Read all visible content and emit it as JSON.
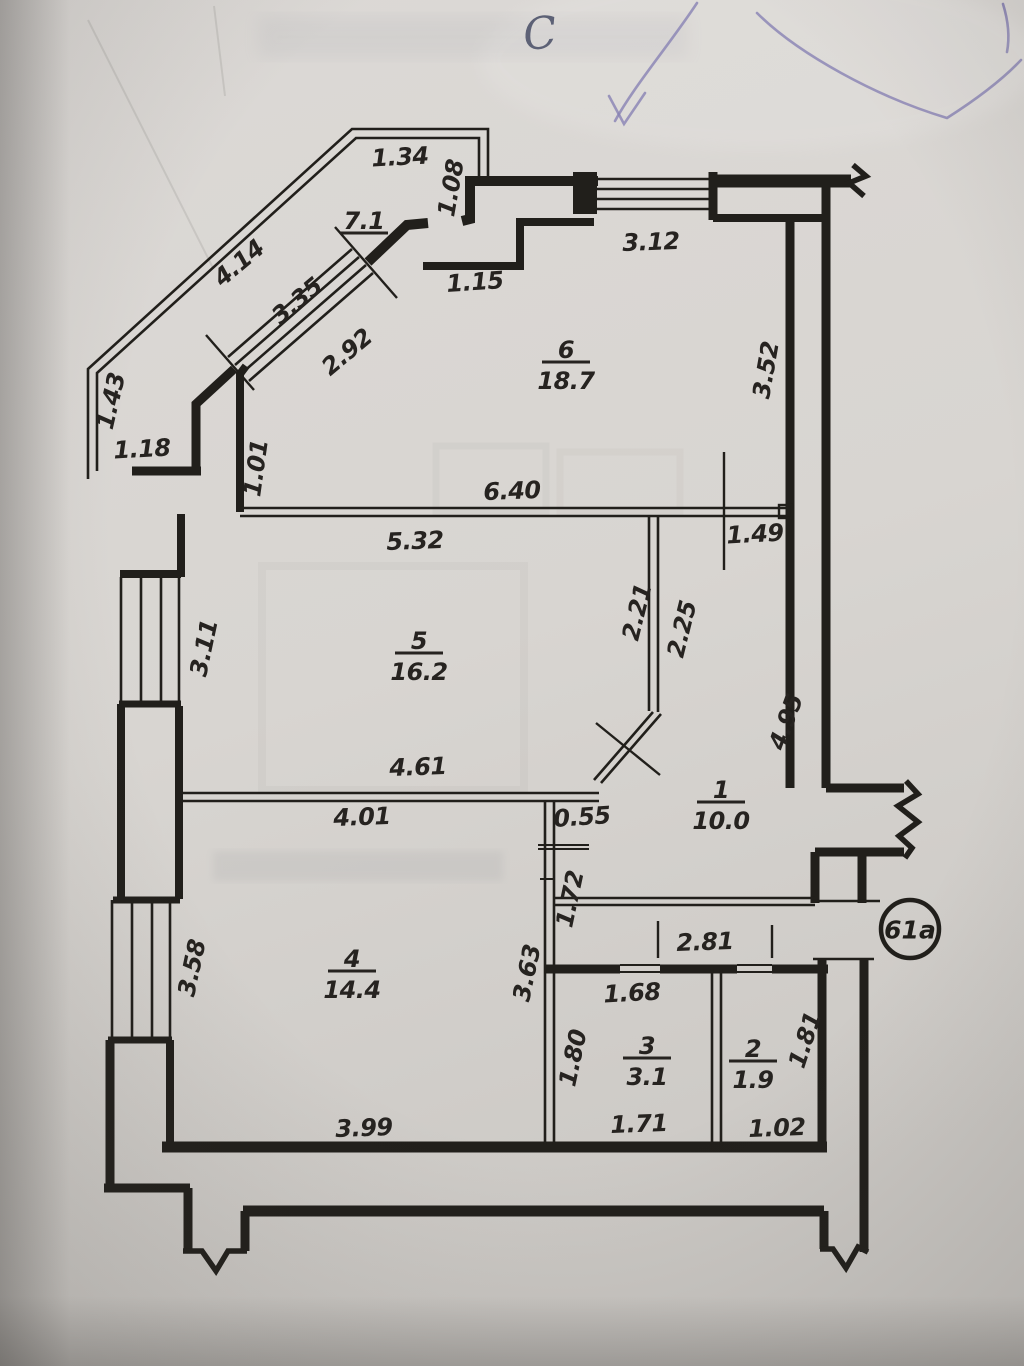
{
  "document": {
    "kind": "scanned apartment floor plan photo",
    "north_mark": "C",
    "apartment_badge": "61a"
  },
  "colors": {
    "paper": "#d8d5d1",
    "ink": "#211f1b",
    "pen_mark": "#7b74ab",
    "label_ink": "#262320"
  },
  "rooms": [
    {
      "name": "room-6",
      "number": "6",
      "area": "18.7",
      "x": 566,
      "y": 350
    },
    {
      "name": "room-5",
      "number": "5",
      "area": "16.2",
      "x": 419,
      "y": 641
    },
    {
      "name": "room-1",
      "number": "1",
      "area": "10.0",
      "x": 721,
      "y": 790
    },
    {
      "name": "room-4",
      "number": "4",
      "area": "14.4",
      "x": 352,
      "y": 959
    },
    {
      "name": "room-3",
      "number": "3",
      "area": "3.1",
      "x": 647,
      "y": 1046
    },
    {
      "name": "room-2",
      "number": "2",
      "area": "1.9",
      "x": 753,
      "y": 1049
    },
    {
      "name": "balcony",
      "number": "7.1",
      "area": "",
      "x": 364,
      "y": 221
    }
  ],
  "dimensions": [
    {
      "t": "1.34",
      "x": 400,
      "y": 157,
      "r": -3
    },
    {
      "t": "1.08",
      "x": 451,
      "y": 188,
      "r": -80
    },
    {
      "t": "4.14",
      "x": 239,
      "y": 263,
      "r": -40
    },
    {
      "t": "3.35",
      "x": 297,
      "y": 301,
      "r": -40
    },
    {
      "t": "2.92",
      "x": 347,
      "y": 352,
      "r": -40
    },
    {
      "t": "1.15",
      "x": 475,
      "y": 282,
      "r": -4
    },
    {
      "t": "1.43",
      "x": 111,
      "y": 401,
      "r": -77
    },
    {
      "t": "1.18",
      "x": 142,
      "y": 449,
      "r": -3
    },
    {
      "t": "1.01",
      "x": 256,
      "y": 468,
      "r": -82
    },
    {
      "t": "3.12",
      "x": 651,
      "y": 242,
      "r": -2
    },
    {
      "t": "3.52",
      "x": 766,
      "y": 370,
      "r": -80
    },
    {
      "t": "6.40",
      "x": 512,
      "y": 491,
      "r": -2
    },
    {
      "t": "5.32",
      "x": 415,
      "y": 541,
      "r": -2
    },
    {
      "t": "1.49",
      "x": 755,
      "y": 534,
      "r": -3
    },
    {
      "t": "2.21",
      "x": 637,
      "y": 612,
      "r": -76
    },
    {
      "t": "2.25",
      "x": 682,
      "y": 629,
      "r": -76
    },
    {
      "t": "3.11",
      "x": 204,
      "y": 648,
      "r": -78
    },
    {
      "t": "4.61",
      "x": 418,
      "y": 767,
      "r": -2
    },
    {
      "t": "4.95",
      "x": 786,
      "y": 722,
      "r": -70
    },
    {
      "t": "4.01",
      "x": 362,
      "y": 817,
      "r": -2
    },
    {
      "t": "0.55",
      "x": 582,
      "y": 817,
      "r": -4
    },
    {
      "t": "1.72",
      "x": 570,
      "y": 899,
      "r": -78
    },
    {
      "t": "3.58",
      "x": 192,
      "y": 968,
      "r": -78
    },
    {
      "t": "3.63",
      "x": 527,
      "y": 973,
      "r": -78
    },
    {
      "t": "2.81",
      "x": 705,
      "y": 942,
      "r": -2
    },
    {
      "t": "1.68",
      "x": 632,
      "y": 993,
      "r": -3
    },
    {
      "t": "1.80",
      "x": 573,
      "y": 1058,
      "r": -78
    },
    {
      "t": "1.81",
      "x": 805,
      "y": 1040,
      "r": -72
    },
    {
      "t": "1.71",
      "x": 639,
      "y": 1124,
      "r": -2
    },
    {
      "t": "1.02",
      "x": 777,
      "y": 1128,
      "r": -2
    },
    {
      "t": "3.99",
      "x": 364,
      "y": 1128,
      "r": -2
    }
  ]
}
